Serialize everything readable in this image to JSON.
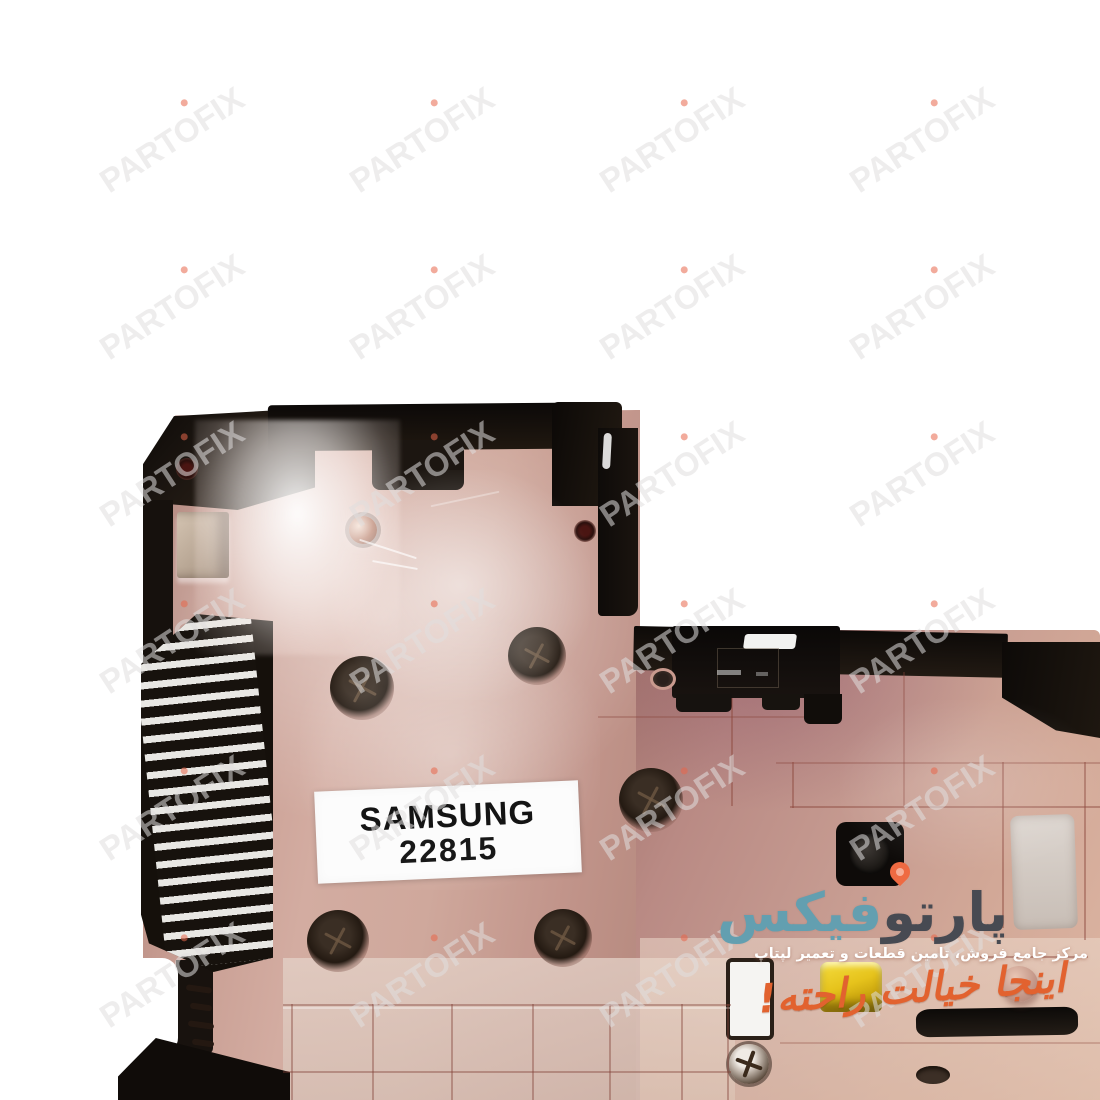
{
  "photo": {
    "description": "laptop-bottom-case-product-photo",
    "label": {
      "line1": "SAMSUNG",
      "line2": "22815"
    }
  },
  "watermark": {
    "text": "PARTOFIX",
    "color": "rgba(224,222,222,0.55)",
    "accent": "#e8664a"
  },
  "logo": {
    "name_dark": "پارتو",
    "name_teal": "فیکس",
    "subtitle": "مرکز جامع فروش، تامین قطعات و تعمیر لپتاپ",
    "tagline": "اینجا خیالت راحته!",
    "colors": {
      "dark": "#474a52",
      "teal": "#639fb0",
      "orange": "#e2622f",
      "pin": "#ef6a42",
      "subtitle": "#ffffff"
    }
  }
}
